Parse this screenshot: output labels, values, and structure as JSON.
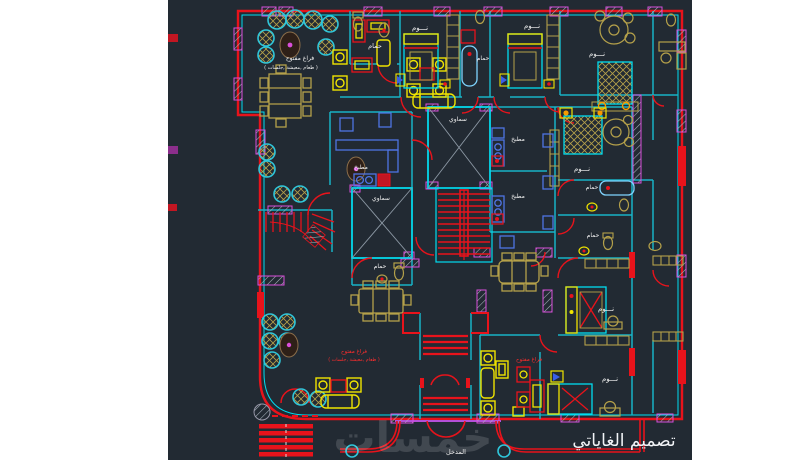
{
  "canvas": {
    "type": "cad-floorplan",
    "background": "#ffffff",
    "drawing_background": "#222a33"
  },
  "colors": {
    "wall_red": "#e8131b",
    "wall_cyan": "#00dcf0",
    "wall_teal": "#17b2c6",
    "window_magenta": "#d94fdb",
    "entrance_purple": "#b44fd8",
    "furniture_yellow": "#f0e400",
    "furniture_tan": "#b5a14a",
    "fixture_blue": "#4f74e3",
    "plant_teal": "#2fc6da",
    "stair_red": "#e8131b",
    "label_white": "#f2f2f2",
    "label_red": "#ff2d2d",
    "shaft_cross_gray": "#8b97a3"
  },
  "labels": {
    "open1a": "فراغ مفتوح",
    "open1b": "( طعام ,معيشة ,جلسات )",
    "open2a": "فراغ مفتوح",
    "open2b": "( طعام ,معيشة ,جلسات )",
    "open3": "فراغ مفتوح",
    "bath_tl": "حمام",
    "bath_tc": "حمام",
    "bath_l": "حمام",
    "bath_r1": "حمام",
    "bath_r2": "حمام",
    "bed_t1": "نـــوم",
    "bed_t2": "نـــوم",
    "bed_tr": "نـــوم",
    "bed_r2": "نـــوم",
    "bed_r3": "نـــوم",
    "bed_r4": "نـــوم",
    "kitchen_l": "مطبخ",
    "kitchen_r1": "مطبخ",
    "kitchen_r2": "مطبخ",
    "sky_top": "سماوي",
    "sky_left": "سماوي",
    "entrance": "المدخل",
    "signature": "تصميم الغاياتي",
    "watermark": "خمسات"
  }
}
